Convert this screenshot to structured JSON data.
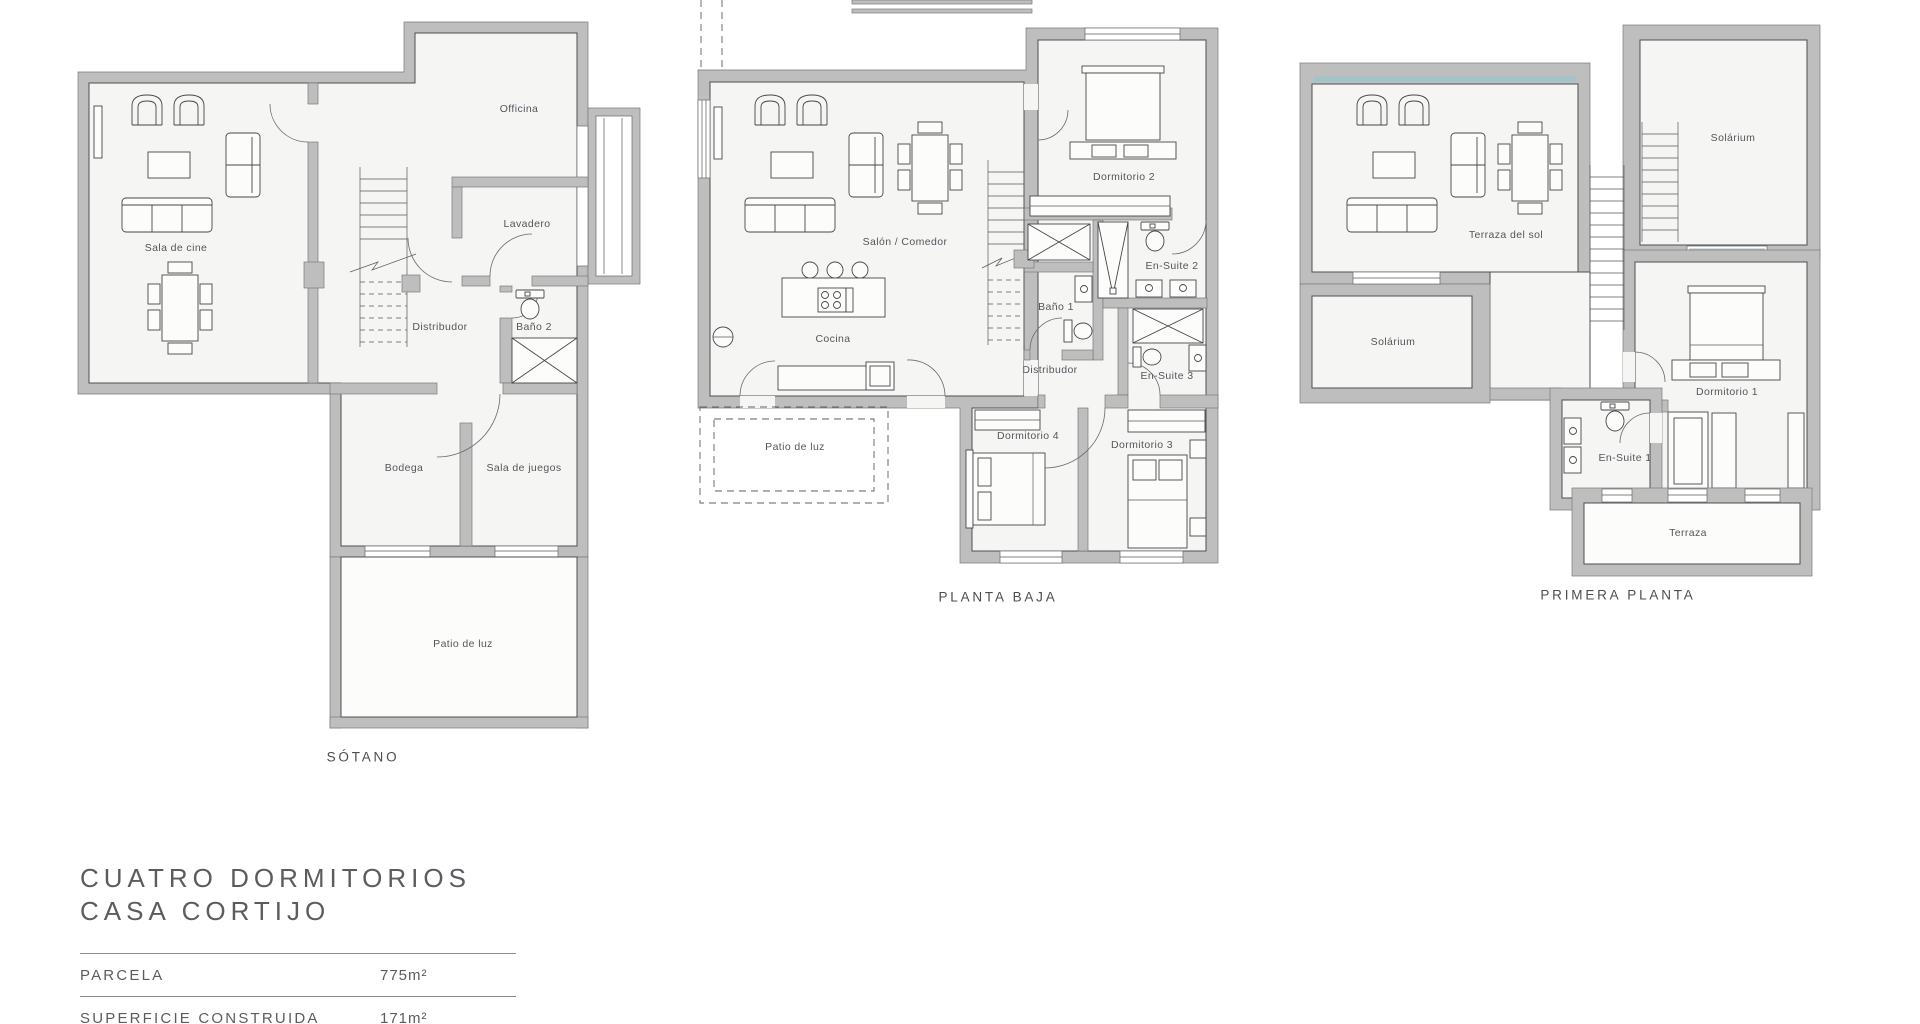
{
  "plans": {
    "sotano": {
      "title": "SÓTANO",
      "rooms": {
        "sala_de_cine": "Sala de cine",
        "officina": "Officina",
        "lavadero": "Lavadero",
        "distribudor": "Distribudor",
        "bano_2": "Baño 2",
        "bodega": "Bodega",
        "sala_de_juegos": "Sala de juegos",
        "patio_de_luz": "Patio de luz"
      }
    },
    "planta_baja": {
      "title": "PLANTA BAJA",
      "rooms": {
        "salon_comedor": "Salón / Comedor",
        "cocina": "Cocina",
        "patio_de_luz": "Patio de luz",
        "dormitorio_2": "Dormitorio 2",
        "en_suite_2": "En-Suite 2",
        "bano_1": "Baño 1",
        "distribudor": "Distribudor",
        "en_suite_3": "En-Suite 3",
        "dormitorio_4": "Dormitorio 4",
        "dormitorio_3": "Dormitorio 3"
      }
    },
    "primera_planta": {
      "title": "PRIMERA PLANTA",
      "rooms": {
        "terraza_del_sol": "Terraza del sol",
        "solarium_top": "Solárium",
        "solarium_left": "Solárium",
        "dormitorio_1": "Dormitorio 1",
        "en_suite_1": "En-Suite 1",
        "terraza": "Terraza"
      }
    }
  },
  "info": {
    "title_line1": "CUATRO DORMITORIOS",
    "title_line2": "CASA CORTIJO",
    "specs": [
      {
        "label": "PARCELA",
        "value": "775m²"
      },
      {
        "label": "SUPERFICIE CONSTRUIDA",
        "value": "171m²"
      }
    ]
  },
  "colors": {
    "wall": "#bdbebd",
    "floor": "#f5f5f4",
    "line": "#474749",
    "glass": "#9fc5ca",
    "text": "#55565a"
  }
}
